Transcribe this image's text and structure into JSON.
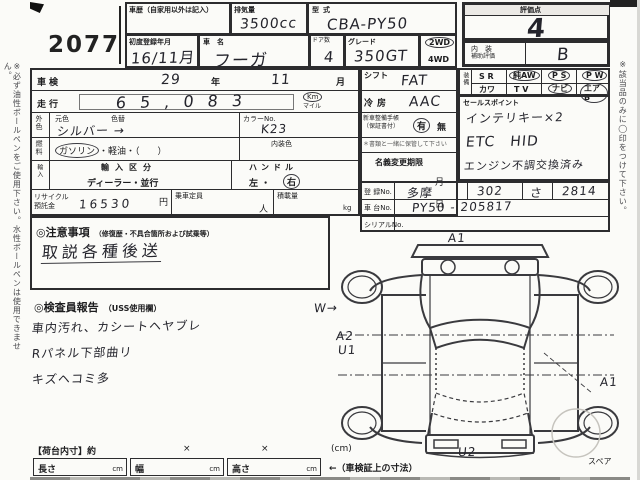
{
  "page": {
    "lot_number": "2077",
    "left_note": "※必ず油性ボールペンをご使用下さい。水性ボールペンは使用できません。",
    "right_note": "※該当品のみに◯印をつけて下さい。"
  },
  "header": {
    "history_label": "車歴（自家用以外は記入）",
    "displacement_label": "排気量",
    "displacement_value": "3500cc",
    "model_label": "型式",
    "model_value": "CBA-PY50",
    "first_reg_label": "初度登録年月",
    "first_reg_value": "16/11月",
    "car_name_label": "車　名",
    "car_name_value": "フーガ",
    "doors_label": "ドア数",
    "doors_value": "4",
    "grade_label": "グレード",
    "grade_value": "350GT",
    "drive_2wd": "2WD",
    "drive_4wd": "4WD",
    "score_label": "評価点",
    "score_value": "4",
    "interior_label1": "内　装",
    "interior_label2": "補助評価",
    "interior_value": "B"
  },
  "left_table": {
    "shaken_label": "車検",
    "shaken_year": "29",
    "year_label": "年",
    "shaken_month": "11",
    "month_label": "月",
    "mileage_label": "走行",
    "mileage_value": "65,083",
    "unit_km": "Km",
    "unit_mile": "マイル",
    "ext_color_side": "外色",
    "base_color_label": "元色",
    "color_change_label": "色替",
    "ext_color_value": "シルバー →",
    "color_no_label": "カラーNo.",
    "color_no_value": "K23",
    "fuel_side": "燃料",
    "fuel_gasoline": "ガソリン",
    "fuel_rest": "・軽油・（　　）",
    "interior_color_label": "内装色",
    "import_side": "輸入",
    "import_label": "輸入区分",
    "import_value": "ディーラー・並行",
    "handle_label": "ハンドル",
    "handle_left": "左 ・",
    "handle_right": "右",
    "recycle_label1": "リサイクル",
    "recycle_label2": "預託金",
    "recycle_value": "16530",
    "recycle_unit": "円",
    "capacity_label": "乗車定員",
    "capacity_unit": "人",
    "load_label": "積載量",
    "load_unit": "kg"
  },
  "right_table": {
    "shift_label": "シフト",
    "shift_value": "FAT",
    "ac_label": "冷房",
    "ac_value": "AAC",
    "book_label1": "新車整備手帳",
    "book_label2": "（保証書付）",
    "book_yes": "有",
    "book_sep": "・",
    "book_no": "無",
    "book_note": "＊書類と一緒に保管して下さい",
    "transfer_label": "名義変更期限",
    "transfer_month": "月",
    "transfer_day": "日"
  },
  "equipment": {
    "side_label": "装備",
    "row1": [
      "S R",
      "純AW",
      "P S",
      "P W"
    ],
    "row2": [
      "カワ",
      "T V",
      "ナビ",
      "エアB"
    ],
    "circled": [
      "純AW",
      "P S",
      "P W",
      "ナビ",
      "エアB"
    ]
  },
  "sales": {
    "label": "セールスポイント",
    "lines": [
      "インテリキー×2",
      "ETC　HID",
      "エンジン不調交換済み"
    ]
  },
  "registration": {
    "reg_label": "登 録No.",
    "reg_values": [
      "多摩",
      "302",
      "さ",
      "2814"
    ],
    "chassis_label": "車 台No.",
    "chassis_value": "PY50 - 205817",
    "serial_label": "シリアルNo.",
    "serial_value": ""
  },
  "caution": {
    "label": "◎注意事項",
    "label_sub": "（修復歴・不具合箇所および試乗等）",
    "line": "取説各種後送"
  },
  "inspector": {
    "label": "◎検査員報告",
    "label_sub": "（USS使用欄）",
    "lines": [
      "車内汚れ、カシートヘヤブレ",
      "Rパネル下部曲リ",
      "キズヘコミ多"
    ]
  },
  "diagram": {
    "ann_top": "A1",
    "ann_left_w": "W→",
    "ann_left_a2": "A2",
    "ann_left_u1": "U1",
    "ann_right": "A1",
    "ann_bottom": "U2",
    "spare_label": "スペア"
  },
  "bottom": {
    "inner_label": "【荷台内寸】約",
    "x1": "×",
    "x2": "×",
    "unit": "(cm)",
    "length_label": "長さ",
    "width_label": "幅",
    "height_label": "高さ",
    "cm1": "cm",
    "cm2": "cm",
    "cm3": "cm",
    "note": "←（車検証上の寸法）"
  }
}
